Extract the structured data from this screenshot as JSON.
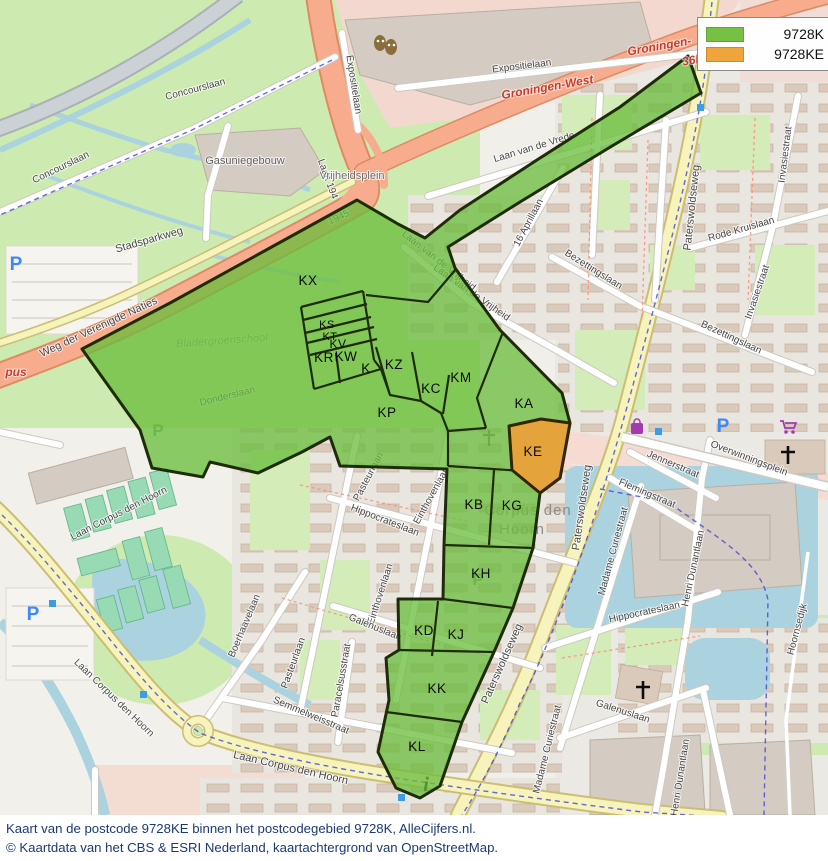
{
  "legend": {
    "items": [
      {
        "label": "9728K",
        "color": "#76c043"
      },
      {
        "label": "9728KE",
        "color": "#f0a43c"
      }
    ]
  },
  "caption": {
    "line1": "Kaart van de postcode 9728KE binnen het postcodegebied 9728K, AlleCijfers.nl.",
    "line2": "© Kaartdata van het CBS & ESRI Nederland, kaartachtergrond van OpenStreetMap."
  },
  "zones": {
    "kx": "KX",
    "ks": "KS",
    "kt": "KT",
    "kv": "KV",
    "kr": "KR",
    "kw": "KW",
    "k": "K",
    "kz": "KZ",
    "kc": "KC",
    "km": "KM",
    "kp": "KP",
    "ka": "KA",
    "ke": "KE",
    "kb": "KB",
    "kg": "KG",
    "kh": "KH",
    "kd": "KD",
    "kj": "KJ",
    "kk": "KK",
    "kl": "KL"
  },
  "streets": {
    "concourslaan_a": "Concourslaan",
    "concourslaan_b": "Concourslaan",
    "stadsparkweg": "Stadsparkweg",
    "weg_der_verenigde": "Weg der Verenigde Naties",
    "laan_1940": "Laan 194",
    "y1945": "1945",
    "expositielaan_a": "Expositielaan",
    "expositielaan_b": "Expositielaan",
    "laan_vrede": "Laan van de Vrede",
    "aprillaan": "16 Aprillaan",
    "laan_vrijheid_a": "Laan van de Vrijheid",
    "laan_vrijheid_b": "Laan van de Vrijheid",
    "bezettingslaan_a": "Bezettingslaan",
    "bezettingslaan_b": "Bezettingslaan",
    "rode_kruislaan": "Rode Kruislaan",
    "invasiestraat_a": "Invasiestraat",
    "invasiestraat_b": "Invasiestraat",
    "paterswoldseweg_a": "Paterswoldseweg",
    "paterswoldseweg_b": "Paterswoldseweg",
    "paterswoldseweg_c": "Paterswoldseweg",
    "overwinningsplein": "Overwinningsplein",
    "jennerstraat": "Jennerstraat",
    "flemingstraat": "Flemingstraat",
    "madame_curiestraat_a": "Madame Curiestraat",
    "madame_curiestraat_b": "Madame Curiestraat",
    "hippocrateslaan_a": "Hippocrateslaan",
    "hippocrateslaan_b": "Hippocrateslaan",
    "pasteurlaan_a": "Pasteurlaan",
    "pasteurlaan_b": "Pasteurlaan",
    "einthovenlaan_a": "Einthovenlaan",
    "einthovenlaan_b": "Einthovenlaan",
    "galenuslaan_a": "Galenuslaan",
    "galenuslaan_b": "Galenuslaan",
    "henri_dunantlaan_a": "Henri Dunantlaan",
    "henri_dunantlaan_b": "Henri Dunantlaan",
    "hoornsedijk": "Hoornsedijk",
    "boerhaavelaan": "Boerhaavelaan",
    "laan_corpus_a": "Laan Corpus den Hoorn",
    "laan_corpus_b": "Laan Corpus den Hoorn",
    "laan_corpus_c": "Laan Corpus den Hoorn",
    "semmelweisstraat": "Semmelweisstraat",
    "paracelsusstraat": "Paracelsusstraat",
    "donderslaan": "Donderslaan"
  },
  "places": {
    "gasuniegebouw": "Gasuniegebouw",
    "bladergroenschool": "Bladergroenschool",
    "vrijheidsplein": "Vrijheidsplein",
    "corpus_den": "Corpus den",
    "hoorn": "Hoorn"
  },
  "highway_labels": {
    "groningen_west_a": "Groningen-West",
    "groningen_west_b": "Groningen-",
    "ref_36b": "36b",
    "pus": "pus"
  },
  "icons": {
    "parking": "P",
    "info": "i"
  },
  "colors": {
    "zone_green": "#76c043",
    "zone_orange": "#eca440",
    "zone_outline": "#1e2c09",
    "water": "#aad3df",
    "motorway": "#f7ac8e"
  }
}
